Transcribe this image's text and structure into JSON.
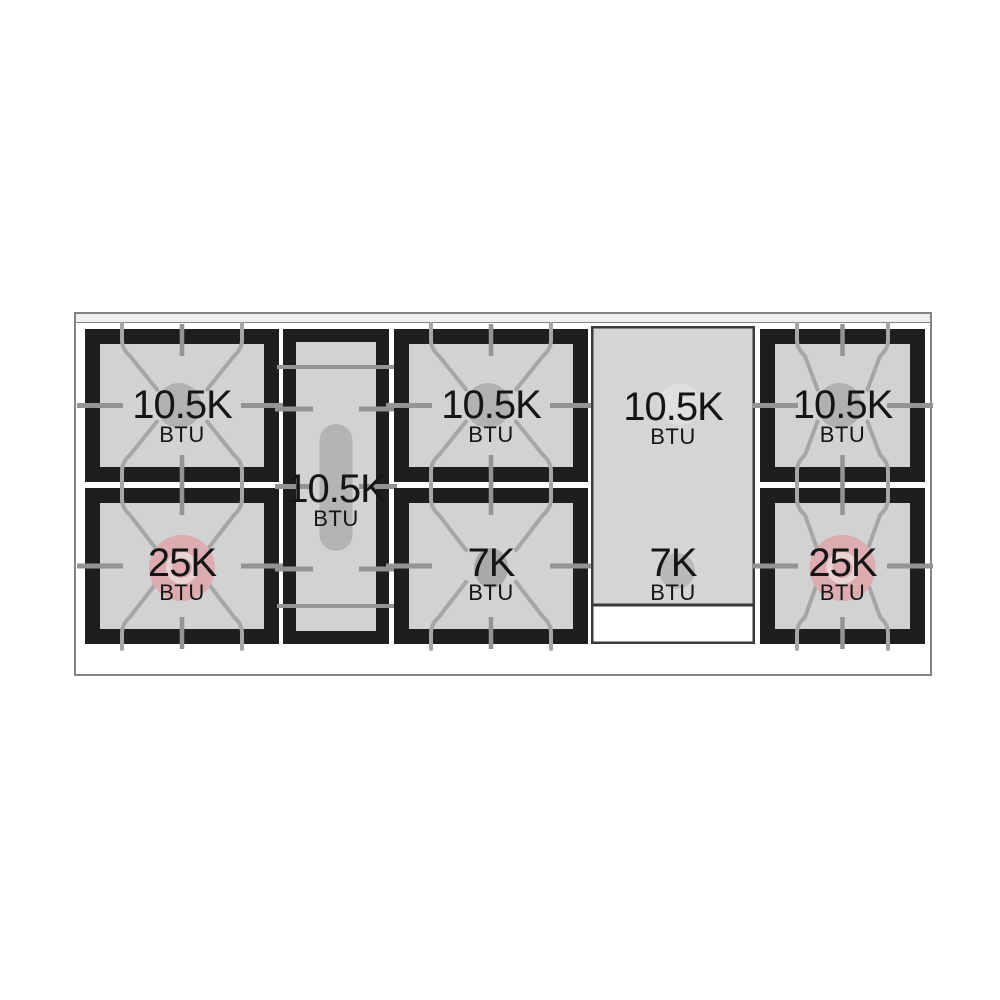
{
  "cooktop": {
    "description": "gas-range-cooktop-burner-layout-diagram",
    "colors": {
      "grate_frame": "#1e1e1e",
      "grate_surface": "#d2d2d2",
      "grate_lines": "#a6a6a6",
      "burner_gray": "#b1b1b1",
      "burner_pink": "#dcacb0",
      "griddle_surface": "#d5d5d5",
      "label_text": "#151515"
    },
    "burners": [
      {
        "position": "left-rear",
        "power": "10.5K",
        "unit": "BTU"
      },
      {
        "position": "left-front",
        "power": "25K",
        "unit": "BTU"
      },
      {
        "position": "center-oval",
        "power": "10.5K",
        "unit": "BTU"
      },
      {
        "position": "middle-rear",
        "power": "10.5K",
        "unit": "BTU"
      },
      {
        "position": "middle-front",
        "power": "7K",
        "unit": "BTU"
      },
      {
        "position": "griddle-rear",
        "power": "10.5K",
        "unit": "BTU"
      },
      {
        "position": "griddle-front",
        "power": "7K",
        "unit": "BTU"
      },
      {
        "position": "right-rear",
        "power": "10.5K",
        "unit": "BTU"
      },
      {
        "position": "right-front",
        "power": "25K",
        "unit": "BTU"
      }
    ]
  }
}
